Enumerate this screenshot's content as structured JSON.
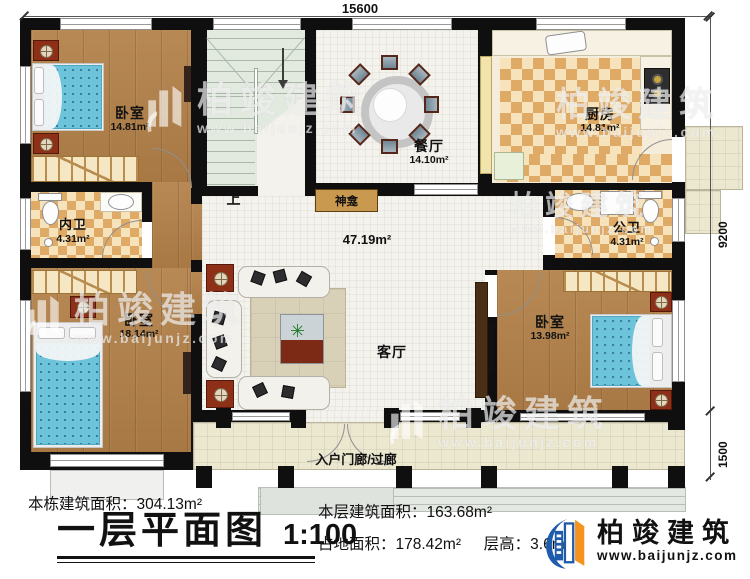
{
  "plan": {
    "dimensions": {
      "top_width": "15600",
      "right_height": "9200",
      "right_porch_depth": "1500"
    },
    "stairs": {
      "direction_label": "上"
    },
    "rooms": {
      "bedroom_top_left": {
        "name": "卧室",
        "area": "14.81m²"
      },
      "inner_bathroom": {
        "name": "内卫",
        "area": "4.31m²"
      },
      "bedroom_bottom_left": {
        "name": "卧室",
        "area": "18.14m²"
      },
      "dining_room": {
        "name": "餐厅",
        "area": "14.10m²"
      },
      "kitchen": {
        "name": "厨房",
        "area": "14.81m²"
      },
      "public_bathroom": {
        "name": "公卫",
        "area": "4.31m²"
      },
      "bedroom_bottom_right": {
        "name": "卧室",
        "area": "13.98m²"
      },
      "living_room": {
        "name": "客厅",
        "area": "47.19m²"
      },
      "shrine": {
        "name": "神龛"
      },
      "entry_porch": {
        "name": "入户门廊/过廊"
      }
    }
  },
  "title_block": {
    "total_area_label": "本栋建筑面积：",
    "total_area_value": "304.13m²",
    "plan_title": "一层平面图",
    "plan_scale": "1:100",
    "floor_area_label": "本层建筑面积：",
    "floor_area_value": "163.68m²",
    "footprint_label": "占地面积：",
    "footprint_value": "178.42m²",
    "height_label": "层高：",
    "height_value": "3.6m"
  },
  "brand": {
    "name": "柏竣建筑",
    "website": "www.baijunjz.com"
  },
  "watermark": {
    "name": "柏竣建筑",
    "website": "www.baijunjz.com"
  },
  "colors": {
    "wall": "#0f0f0f",
    "wood": "#b28048",
    "tile_light": "#f6e3bb",
    "tile_dark": "#dfa966",
    "floor_light": "#f3f2ec",
    "porch": "#ece7cf",
    "stairs": "#e2e9df",
    "brand_blue": "#1e5cab",
    "brand_orange": "#f6921e"
  }
}
